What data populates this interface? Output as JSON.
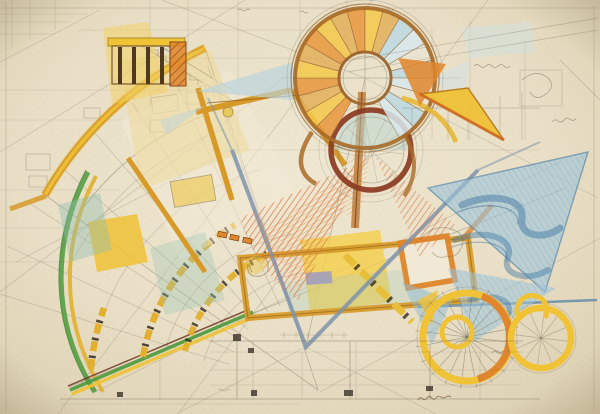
{
  "artwork": {
    "kind": "hand-drawn architectural concept drawing",
    "legible_text": []
  },
  "palette": {
    "paper": "#ece3cd",
    "paperMid": "#e7dcc2",
    "paperEdge": "#d8cbab",
    "pencil": "#6f6758",
    "yellow": "#f0c236",
    "amber": "#e3ac30",
    "mustard": "#d79a28",
    "orange": "#e0862c",
    "coral": "#dd7845",
    "maroon": "#8a3a22",
    "brown": "#a96b28",
    "darkbar": "#4f3a20",
    "slate": "#7e93ab",
    "water": "#9cc4da",
    "deepwater": "#4379a3",
    "stepblue": "#bcd8e2",
    "green": "#4e9a3c",
    "teal": "#8ebfae",
    "lavender": "#9a97c8",
    "cream": "#f2ead6"
  },
  "generated": {
    "spiral": {
      "cx": 365,
      "cy": 78,
      "innerR": 26,
      "outerR": 70,
      "startDeg": 120,
      "endDeg": 420,
      "stepDeg": 15,
      "warmSplitDeg": 300,
      "warm": [
        "#e8973c",
        "#f3c84a",
        "#e2b05a"
      ],
      "cool": [
        "#bcd8e2",
        "#d8e8ec",
        "#e8e4d2"
      ]
    },
    "spokeSets": [
      {
        "cx": 467,
        "cy": 337,
        "r": 52,
        "count": 20,
        "opacity": 0.5
      },
      {
        "cx": 541,
        "cy": 338,
        "r": 34,
        "count": 12,
        "opacity": 0.4
      },
      {
        "cx": 371,
        "cy": 150,
        "r": 33,
        "count": 10,
        "opacity": 0.25
      }
    ],
    "fanRays": {
      "cx": 320,
      "cy": 392,
      "rInner": 95,
      "rOuter": 345,
      "angles": [
        197,
        205,
        213,
        221,
        229,
        237,
        245,
        251
      ],
      "opacity": 0.3
    }
  }
}
